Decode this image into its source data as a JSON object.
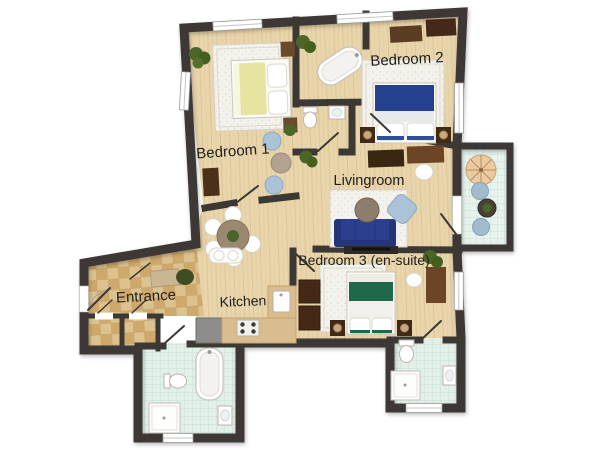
{
  "plan": {
    "type": "apartment floor plan, top view",
    "background": "#ffffff"
  },
  "rooms": {
    "bedroom1": {
      "label": "Bedroom 1"
    },
    "bedroom2": {
      "label": "Bedroom 2"
    },
    "livingroom": {
      "label": "Livingroom"
    },
    "bedroom3": {
      "label": "Bedroom 3 (en-suite)"
    },
    "entrance": {
      "label": "Entrance"
    },
    "kitchen": {
      "label": "Kitchen"
    }
  },
  "palette": {
    "wall": "#3c3935",
    "wood_floor": "#e9d5ab",
    "bathroom_tile": "#e3f0e9",
    "balcony_tile": "#e7f3ed",
    "entrance_tile_light": "#dcc28f",
    "entrance_tile_dark": "#cfa96b",
    "rug": "#f4f2ec",
    "bed1_duvet": "#e7e4a2",
    "bed2_duvet": "#24418e",
    "bed3_duvet": "#20684a",
    "sofa": "#2c3f8e",
    "armchair": "#abc3d6",
    "dining_table": "#9b8871",
    "coffee_table": "#8d7d6c",
    "dark_wood": "#3a2712",
    "mid_wood": "#6b4526",
    "umbrella": "#eccaa0",
    "balcony_chair": "#a3bccd",
    "plant": "#4c6629"
  }
}
